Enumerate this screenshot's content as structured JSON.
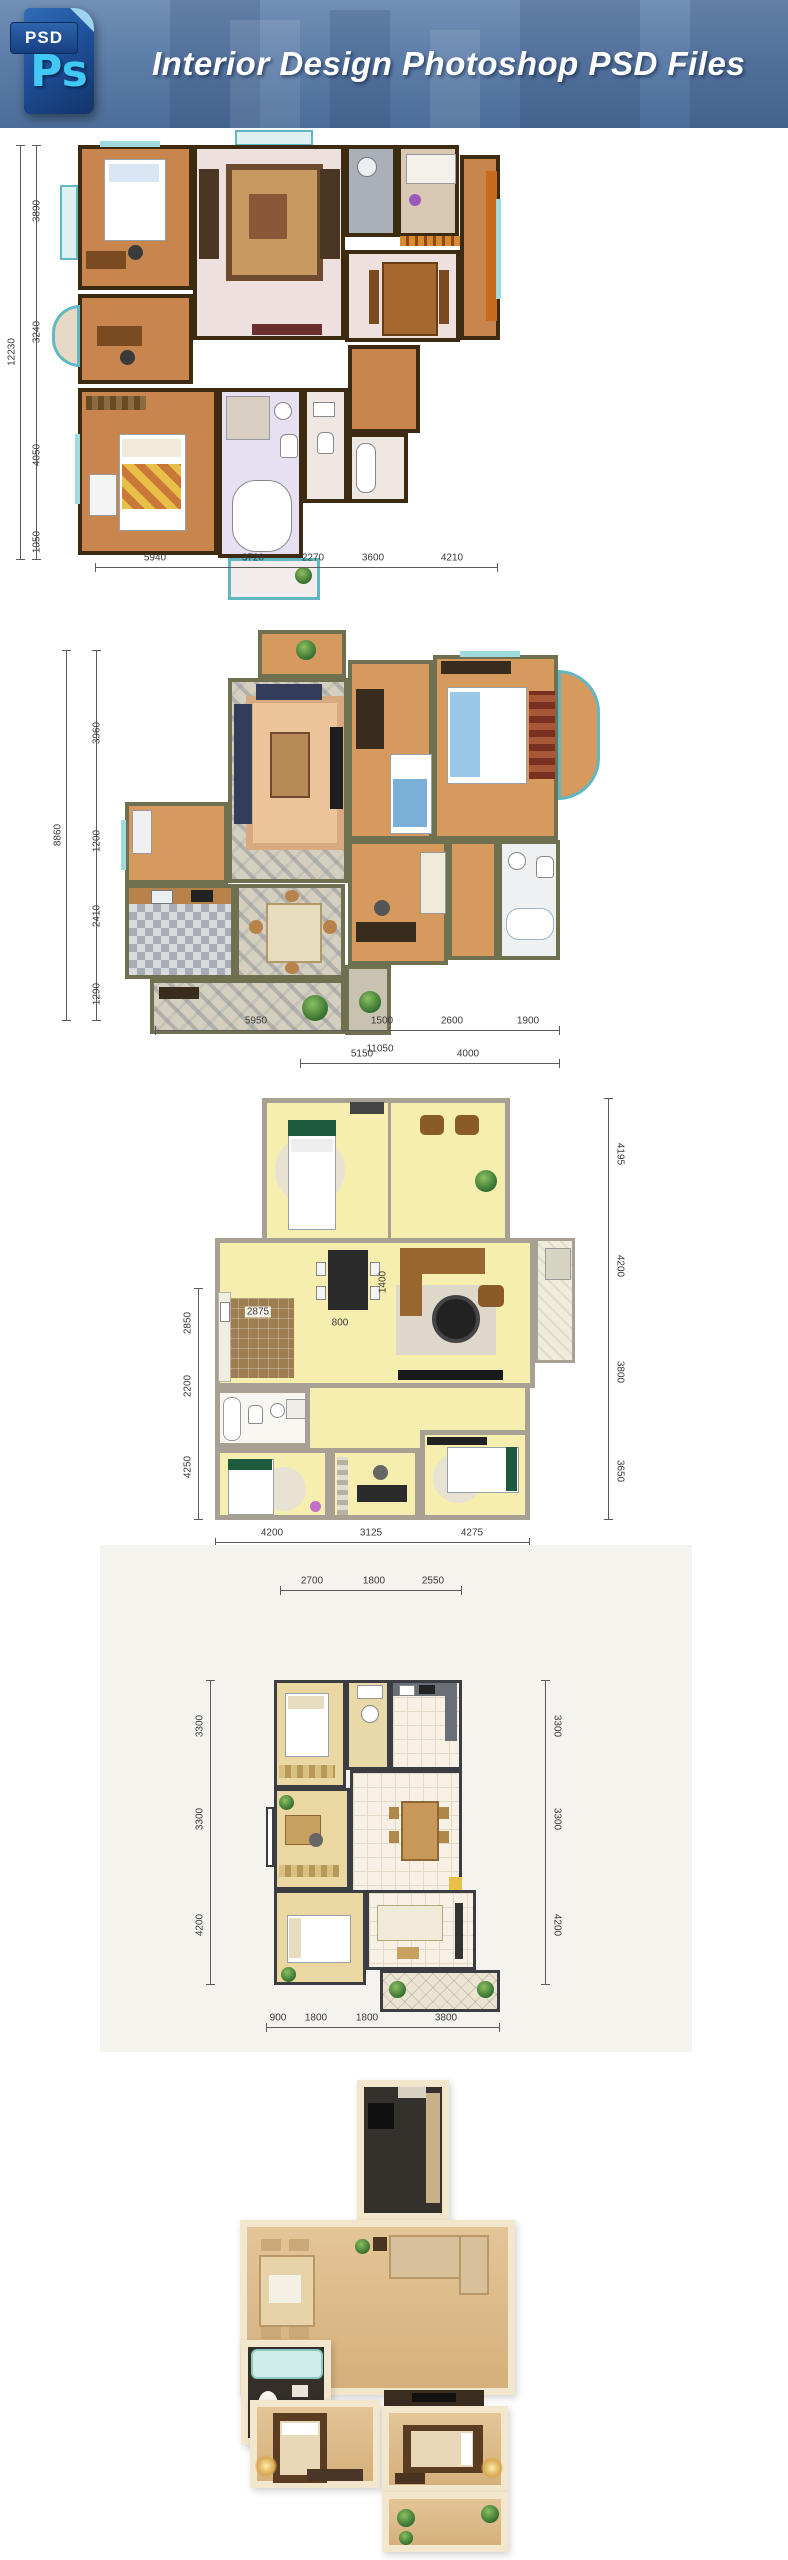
{
  "header": {
    "title": "Interior Design Photoshop PSD Files",
    "icon_tab_label": "PSD",
    "icon_logo_label": "Ps"
  },
  "colors": {
    "banner_blue": "#5d7ea9",
    "icon_dark_blue": "#1d4d96",
    "icon_cyan": "#41c8f5",
    "title_text": "#ffffff",
    "plan1_wall": "#3c2b10",
    "plan2_wall": "#6f7050",
    "plan3_wall": "#a8a092",
    "plan4_wall": "#3b3d42",
    "plan5_wall": "#f2e7cc",
    "window_teal": "#62b8c0"
  },
  "plans": {
    "p1": {
      "left_total": "12230",
      "left": [
        "3890",
        "3240",
        "4050",
        "1050"
      ],
      "bottom": [
        "5940",
        "3720",
        "2270",
        "3600",
        "4210"
      ]
    },
    "p2": {
      "left_total": "8860",
      "left": [
        "3960",
        "1200",
        "2410",
        "1290"
      ],
      "bottom": [
        "5950",
        "1500",
        "2600",
        "1900"
      ],
      "bottom_total": "11050"
    },
    "p3": {
      "top": [
        "5150",
        "4000"
      ],
      "right": [
        "4195",
        "4200",
        "3800",
        "3650"
      ],
      "left": [
        "2850",
        "2200",
        "4250"
      ],
      "bottom": [
        "4200",
        "3125",
        "4275"
      ],
      "interior": [
        "2875",
        "800",
        "1400"
      ]
    },
    "p4": {
      "top": [
        "2700",
        "1800",
        "2550"
      ],
      "left": [
        "3300",
        "3300",
        "4200"
      ],
      "right": [
        "3300",
        "3300",
        "4200"
      ],
      "bottom": [
        "900",
        "1800",
        "1800",
        "3800"
      ]
    },
    "p5": {}
  }
}
